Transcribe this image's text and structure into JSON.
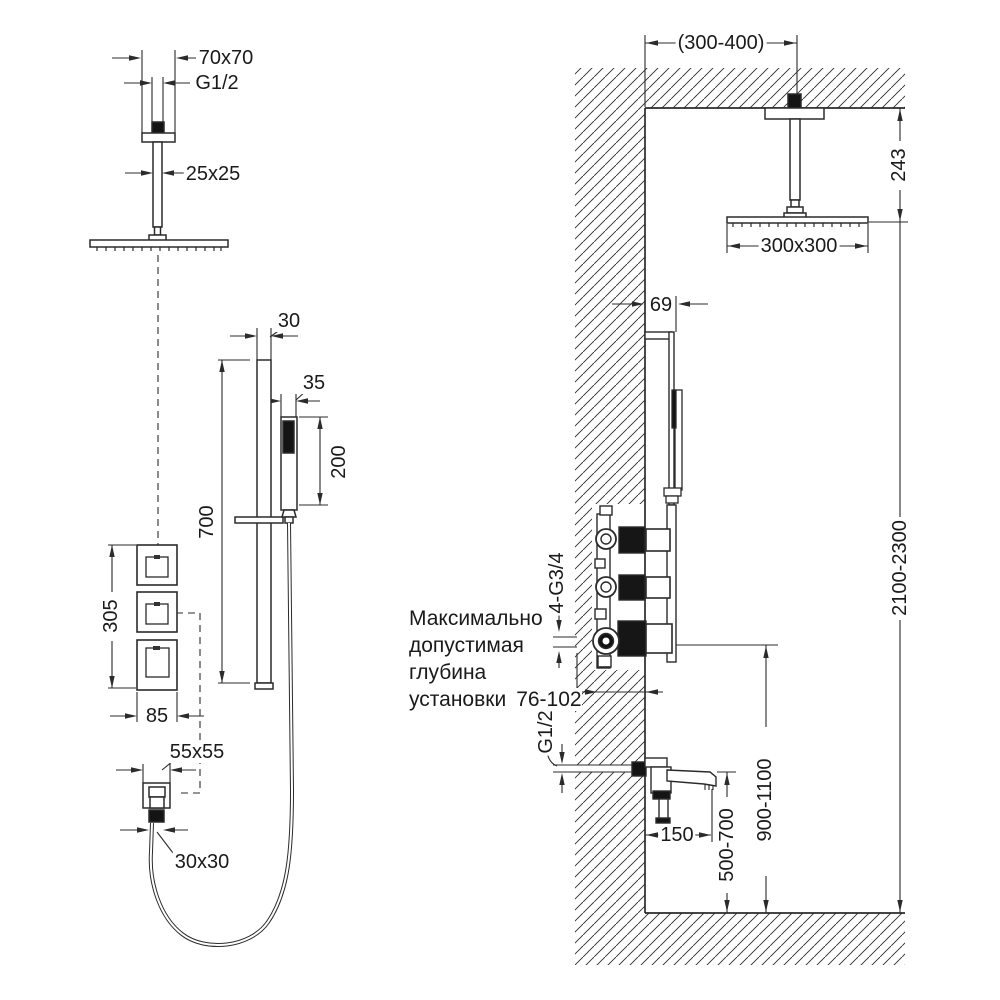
{
  "drawing": {
    "note_lines": [
      "Максимально",
      "допустимая",
      "глубина",
      "установки"
    ],
    "dims": {
      "head_flange": "70x70",
      "head_thread": "G1/2",
      "arm_profile": "25x25",
      "bar_width": "30",
      "hand_width": "35",
      "hand_length": "200",
      "bar_length": "700",
      "panel_height": "305",
      "panel_width": "85",
      "outlet_plate": "55x55",
      "outlet_conn": "30x30",
      "ceiling_offset": "(300-400)",
      "head_drop": "243",
      "head_size": "300x300",
      "bar_offset": "69",
      "ports_thread": "4-G3/4",
      "install_depth": "76-102",
      "spout_thread": "G1/2",
      "spout_reach": "150",
      "spout_height": "500-700",
      "valve_height": "900-1100",
      "room_height": "2100-2300"
    },
    "colors": {
      "line": "#2b2b2b",
      "fill_dark": "#141414",
      "text": "#1a1a1a",
      "background": "#ffffff"
    }
  }
}
